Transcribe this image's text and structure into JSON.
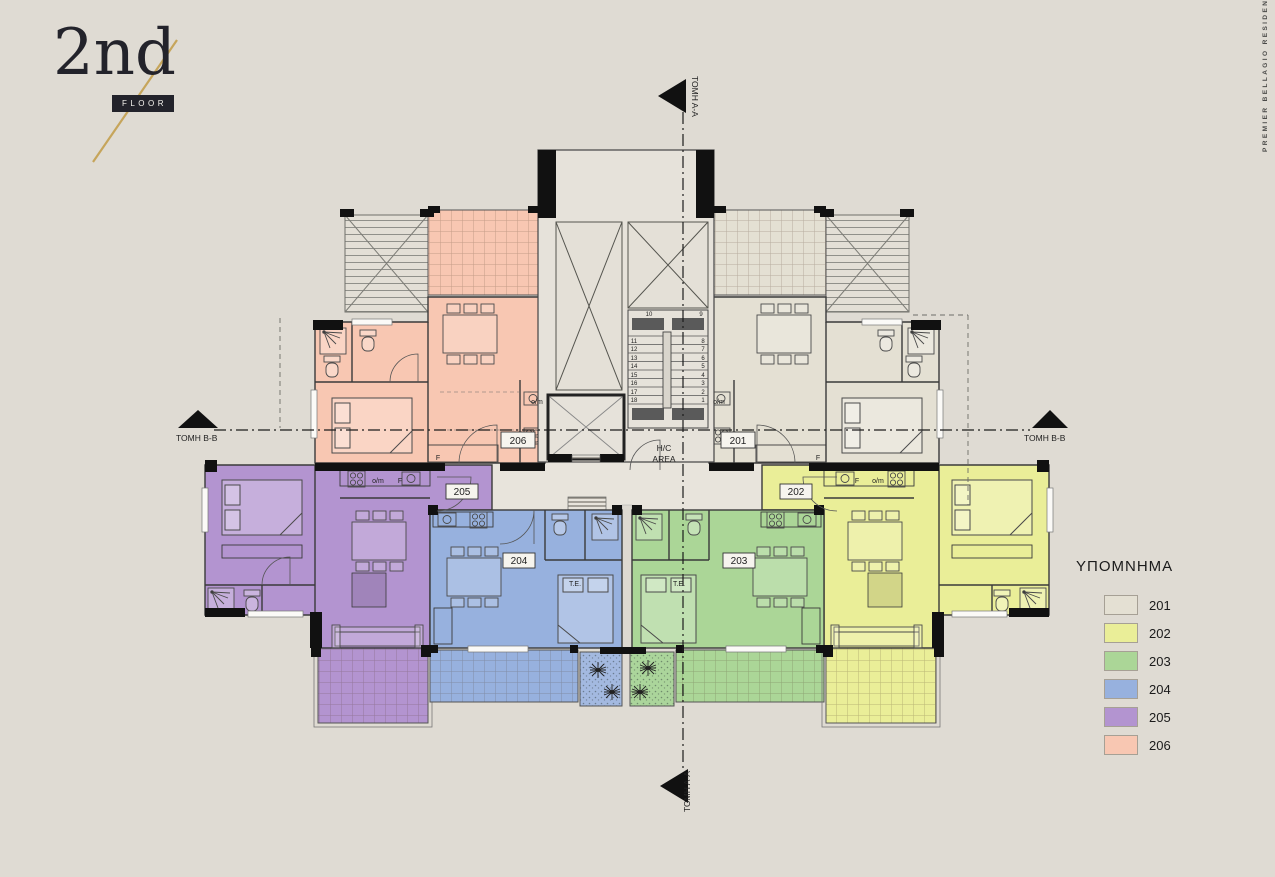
{
  "title_block": {
    "floor_number": "2nd",
    "floor_word": "FLOOR",
    "accent_color": "#c6a55b"
  },
  "brand": {
    "text": "PREMIER BELLAGIO RESIDENCES"
  },
  "legend": {
    "title": "ΥΠΟΜΝΗΜΑ",
    "items": [
      {
        "label": "201",
        "color": "#e4e0d3"
      },
      {
        "label": "202",
        "color": "#eaee98"
      },
      {
        "label": "203",
        "color": "#abd697"
      },
      {
        "label": "204",
        "color": "#97b1de"
      },
      {
        "label": "205",
        "color": "#b394d0"
      },
      {
        "label": "206",
        "color": "#f8c7b2"
      }
    ]
  },
  "plan": {
    "section_aa": "TOMH A-A",
    "section_bb": "TOMH B-B",
    "room_labels": {
      "om": "o/m",
      "f": "F",
      "te": "T.E.",
      "hc1": "H/C",
      "hc2": "AREA"
    },
    "planters": {
      "blue": "#a3b9e0",
      "green": "#abd59b"
    },
    "stairs": {
      "top": [
        "10",
        "9"
      ],
      "left": [
        "11",
        "12",
        "13",
        "14",
        "15",
        "16",
        "17",
        "18"
      ],
      "right": [
        "8",
        "7",
        "6",
        "5",
        "4",
        "3",
        "2",
        "1"
      ]
    }
  }
}
